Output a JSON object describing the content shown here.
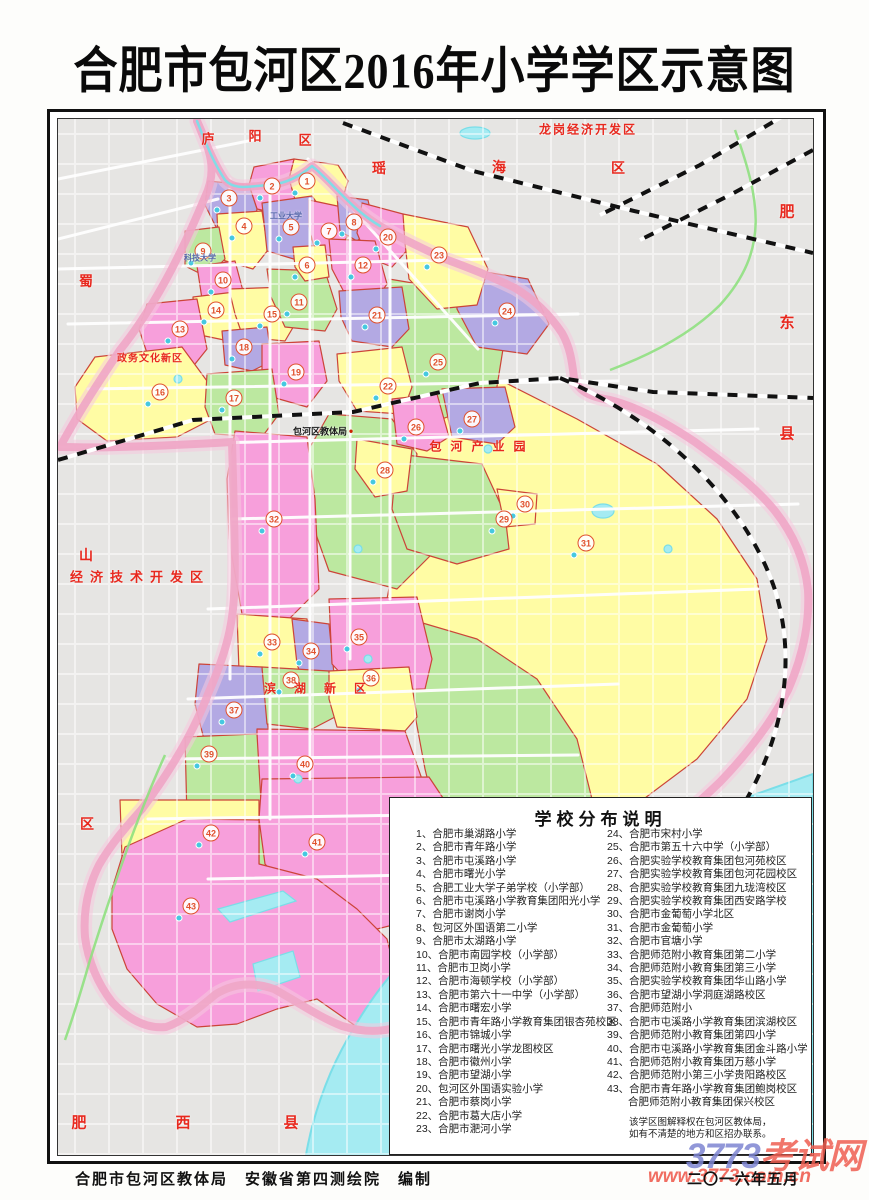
{
  "title": "合肥市包河区2016年小学学区示意图",
  "legend": {
    "title": "学校分布说明",
    "col1": [
      "1、合肥市巢湖路小学",
      "2、合肥市青年路小学",
      "3、合肥市屯溪路小学",
      "4、合肥市曙光小学",
      "5、合肥工业大学子弟学校（小学部）",
      "6、合肥市屯溪路小学教育集团阳光小学",
      "7、合肥市谢岗小学",
      "8、包河区外国语第二小学",
      "9、合肥市太湖路小学",
      "10、合肥市南园学校（小学部）",
      "11、合肥市卫岗小学",
      "12、合肥市海顿学校（小学部）",
      "13、合肥市第六十一中学（小学部）",
      "14、合肥市曙宏小学",
      "15、合肥市青年路小学教育集团银杏苑校区",
      "16、合肥市锦城小学",
      "17、合肥市曙光小学龙图校区",
      "18、合肥市徽州小学",
      "19、合肥市望湖小学",
      "20、包河区外国语实验小学",
      "21、合肥市蔡岗小学",
      "22、合肥市葛大店小学",
      "23、合肥市淝河小学"
    ],
    "col2": [
      "24、合肥市宋村小学",
      "25、合肥市第五十六中学（小学部）",
      "26、合肥实验学校教育集团包河苑校区",
      "27、合肥实验学校教育集团包河花园校区",
      "28、合肥实验学校教育集团九珑湾校区",
      "29、合肥实验学校教育集团西安路学校",
      "30、合肥市金葡萄小学北区",
      "31、合肥市金葡萄小学",
      "32、合肥市官塘小学",
      "33、合肥师范附小教育集团第二小学",
      "34、合肥师范附小教育集团第三小学",
      "35、合肥实验学校教育集团华山路小学",
      "36、合肥市望湖小学洞庭湖路校区",
      "37、合肥师范附小",
      "38、合肥市屯溪路小学教育集团滨湖校区",
      "39、合肥师范附小教育集团第四小学",
      "40、合肥市屯溪路小学教育集团金斗路小学",
      "41、合肥师范附小教育集团万慈小学",
      "42、合肥师范附小第三小学贵阳路校区",
      "43、合肥市青年路小学教育集团鲍岗校区",
      "　　合肥师范附小教育集团保兴校区"
    ],
    "note1": "该学区图解释权在包河区教体局，",
    "note2": "如有不清楚的地方和区招办联系。"
  },
  "footer": {
    "credits": "合肥市包河区教体局　安徽省第四测绘院　编制",
    "date": "二〇一六年五月"
  },
  "watermark": {
    "num": "3773",
    "cjk": "考试网",
    "url": "www.3773.com.cn"
  },
  "map": {
    "markers": [
      {
        "n": "1",
        "x": 249,
        "y": 62
      },
      {
        "n": "2",
        "x": 214,
        "y": 67
      },
      {
        "n": "3",
        "x": 171,
        "y": 79
      },
      {
        "n": "4",
        "x": 186,
        "y": 107
      },
      {
        "n": "5",
        "x": 233,
        "y": 108
      },
      {
        "n": "6",
        "x": 249,
        "y": 146
      },
      {
        "n": "7",
        "x": 271,
        "y": 112
      },
      {
        "n": "8",
        "x": 296,
        "y": 103
      },
      {
        "n": "9",
        "x": 145,
        "y": 132
      },
      {
        "n": "10",
        "x": 165,
        "y": 161
      },
      {
        "n": "11",
        "x": 241,
        "y": 183
      },
      {
        "n": "12",
        "x": 305,
        "y": 146
      },
      {
        "n": "13",
        "x": 122,
        "y": 210
      },
      {
        "n": "14",
        "x": 158,
        "y": 191
      },
      {
        "n": "15",
        "x": 214,
        "y": 195
      },
      {
        "n": "16",
        "x": 102,
        "y": 273
      },
      {
        "n": "17",
        "x": 176,
        "y": 279
      },
      {
        "n": "18",
        "x": 186,
        "y": 228
      },
      {
        "n": "19",
        "x": 238,
        "y": 253
      },
      {
        "n": "20",
        "x": 330,
        "y": 118
      },
      {
        "n": "21",
        "x": 319,
        "y": 196
      },
      {
        "n": "22",
        "x": 330,
        "y": 267
      },
      {
        "n": "23",
        "x": 381,
        "y": 136
      },
      {
        "n": "24",
        "x": 449,
        "y": 192
      },
      {
        "n": "25",
        "x": 380,
        "y": 243
      },
      {
        "n": "26",
        "x": 358,
        "y": 308
      },
      {
        "n": "27",
        "x": 414,
        "y": 300
      },
      {
        "n": "28",
        "x": 327,
        "y": 351
      },
      {
        "n": "29",
        "x": 446,
        "y": 400
      },
      {
        "n": "30",
        "x": 467,
        "y": 385
      },
      {
        "n": "31",
        "x": 528,
        "y": 424
      },
      {
        "n": "32",
        "x": 216,
        "y": 400
      },
      {
        "n": "33",
        "x": 214,
        "y": 523
      },
      {
        "n": "34",
        "x": 253,
        "y": 532
      },
      {
        "n": "35",
        "x": 301,
        "y": 518
      },
      {
        "n": "36",
        "x": 313,
        "y": 559
      },
      {
        "n": "37",
        "x": 176,
        "y": 591
      },
      {
        "n": "38",
        "x": 233,
        "y": 561
      },
      {
        "n": "39",
        "x": 151,
        "y": 635
      },
      {
        "n": "40",
        "x": 247,
        "y": 645
      },
      {
        "n": "41",
        "x": 259,
        "y": 723
      },
      {
        "n": "42",
        "x": 153,
        "y": 714
      },
      {
        "n": "43",
        "x": 133,
        "y": 787
      }
    ],
    "labels": [
      {
        "t": "庐",
        "x": 150,
        "y": 19,
        "fs": 13
      },
      {
        "t": "阳",
        "x": 197,
        "y": 16,
        "fs": 13
      },
      {
        "t": "区",
        "x": 247,
        "y": 20,
        "fs": 13
      },
      {
        "t": "瑶",
        "x": 321,
        "y": 49,
        "fs": 14
      },
      {
        "t": "海",
        "x": 441,
        "y": 48,
        "fs": 14
      },
      {
        "t": "区",
        "x": 560,
        "y": 49,
        "fs": 14
      },
      {
        "t": "龙岗经济开发区",
        "x": 530,
        "y": 10,
        "fs": 12,
        "ls": 2
      },
      {
        "t": "肥",
        "x": 729,
        "y": 92,
        "fs": 15
      },
      {
        "t": "东",
        "x": 729,
        "y": 203,
        "fs": 15
      },
      {
        "t": "县",
        "x": 729,
        "y": 314,
        "fs": 15
      },
      {
        "t": "蜀",
        "x": 28,
        "y": 162,
        "fs": 14
      },
      {
        "t": "山",
        "x": 28,
        "y": 436,
        "fs": 14
      },
      {
        "t": "区",
        "x": 29,
        "y": 705,
        "fs": 14
      },
      {
        "t": "政务文化新区",
        "x": 92,
        "y": 238,
        "fs": 10,
        "ls": 1
      },
      {
        "t": "经济技术开发区",
        "x": 82,
        "y": 457,
        "fs": 13,
        "ls": 7
      },
      {
        "t": "包河产业园",
        "x": 424,
        "y": 327,
        "fs": 12,
        "ls": 9
      },
      {
        "t": "滨湖新区",
        "x": 266,
        "y": 569,
        "fs": 12,
        "ls": 18
      },
      {
        "t": "肥",
        "x": 21,
        "y": 1003,
        "fs": 15
      },
      {
        "t": "西",
        "x": 125,
        "y": 1003,
        "fs": 15
      },
      {
        "t": "县",
        "x": 233,
        "y": 1003,
        "fs": 15
      }
    ],
    "poi": [
      {
        "t": "包河区教体局",
        "x": 262,
        "y": 312,
        "fs": 9,
        "c": "#1a1a1a"
      },
      {
        "t": "●",
        "x": 293,
        "y": 312,
        "fs": 8,
        "c": "#cc2200"
      },
      {
        "t": "工业大学",
        "x": 228,
        "y": 97,
        "fs": 8,
        "c": "#5566aa"
      },
      {
        "t": "科技大学",
        "x": 142,
        "y": 139,
        "fs": 8,
        "c": "#5566aa"
      }
    ]
  },
  "colors": {
    "yellow": "#fffca4",
    "green": "#bce8a0",
    "pink": "#f79fdb",
    "purple": "#b3a9e3",
    "band": "#f0a6c6",
    "band_glow": "#f6c9de",
    "outside": "#e6e5e3",
    "water": "#a5ebf2",
    "water_line": "#7adee8",
    "marker": "#e0512d",
    "border_red": "#cc4438",
    "label_red": "#e8281e",
    "rail": "#111111",
    "expressway": "#8fe080",
    "road": "#ffffff"
  }
}
